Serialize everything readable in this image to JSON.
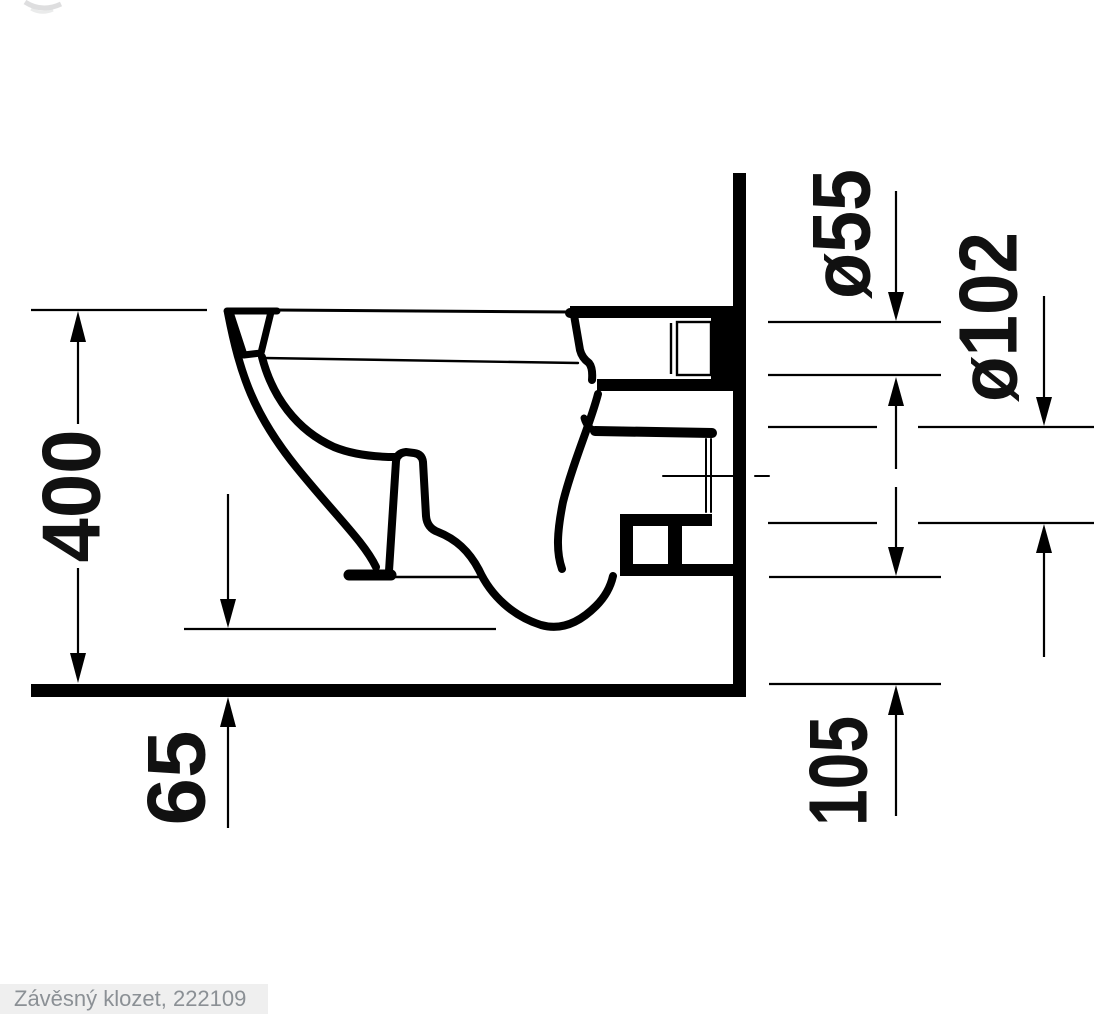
{
  "drawing": {
    "title_caption": "Závěsný klozet, 222109",
    "dimensions": {
      "overall_height": "400",
      "rim_to_floor_clearance": "65",
      "outlet_bottom_height": "105",
      "flush_connector_diameter": "ø55",
      "outlet_diameter": "ø102"
    },
    "colors": {
      "line": "#000000",
      "caption_text": "#8b9095",
      "caption_background": "#efefef"
    }
  }
}
